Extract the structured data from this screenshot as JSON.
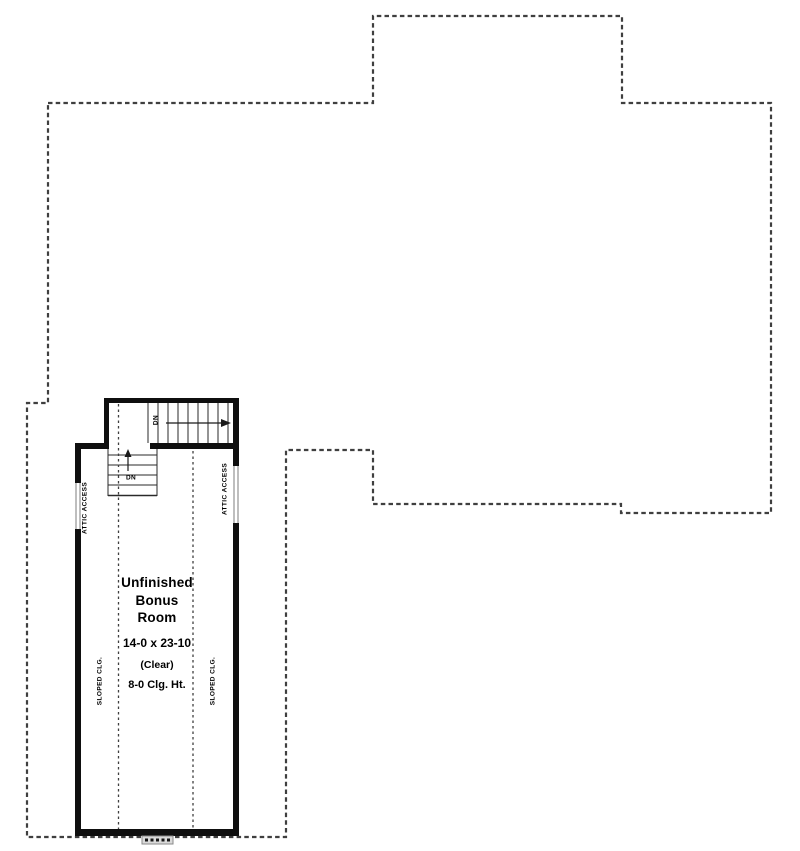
{
  "plan": {
    "room": {
      "name_lines": "Unfinished\nBonus\nRoom",
      "dimensions": "14-0 x 23-10",
      "clear_note": "(Clear)",
      "ceiling_height": "8-0 Clg. Ht."
    },
    "labels": {
      "sloped_clg_left": "SLOPED CLG.",
      "sloped_clg_right": "SLOPED CLG.",
      "attic_access_left": "ATTIC ACCESS",
      "attic_access_right": "ATTIC ACCESS",
      "stairs_down_upper": "DN",
      "stairs_down_lower": "DN"
    },
    "colors": {
      "background": "#ffffff",
      "wall": "#0f0f0f",
      "dashed_outline": "#3f3f3f",
      "text": "#000000"
    }
  }
}
